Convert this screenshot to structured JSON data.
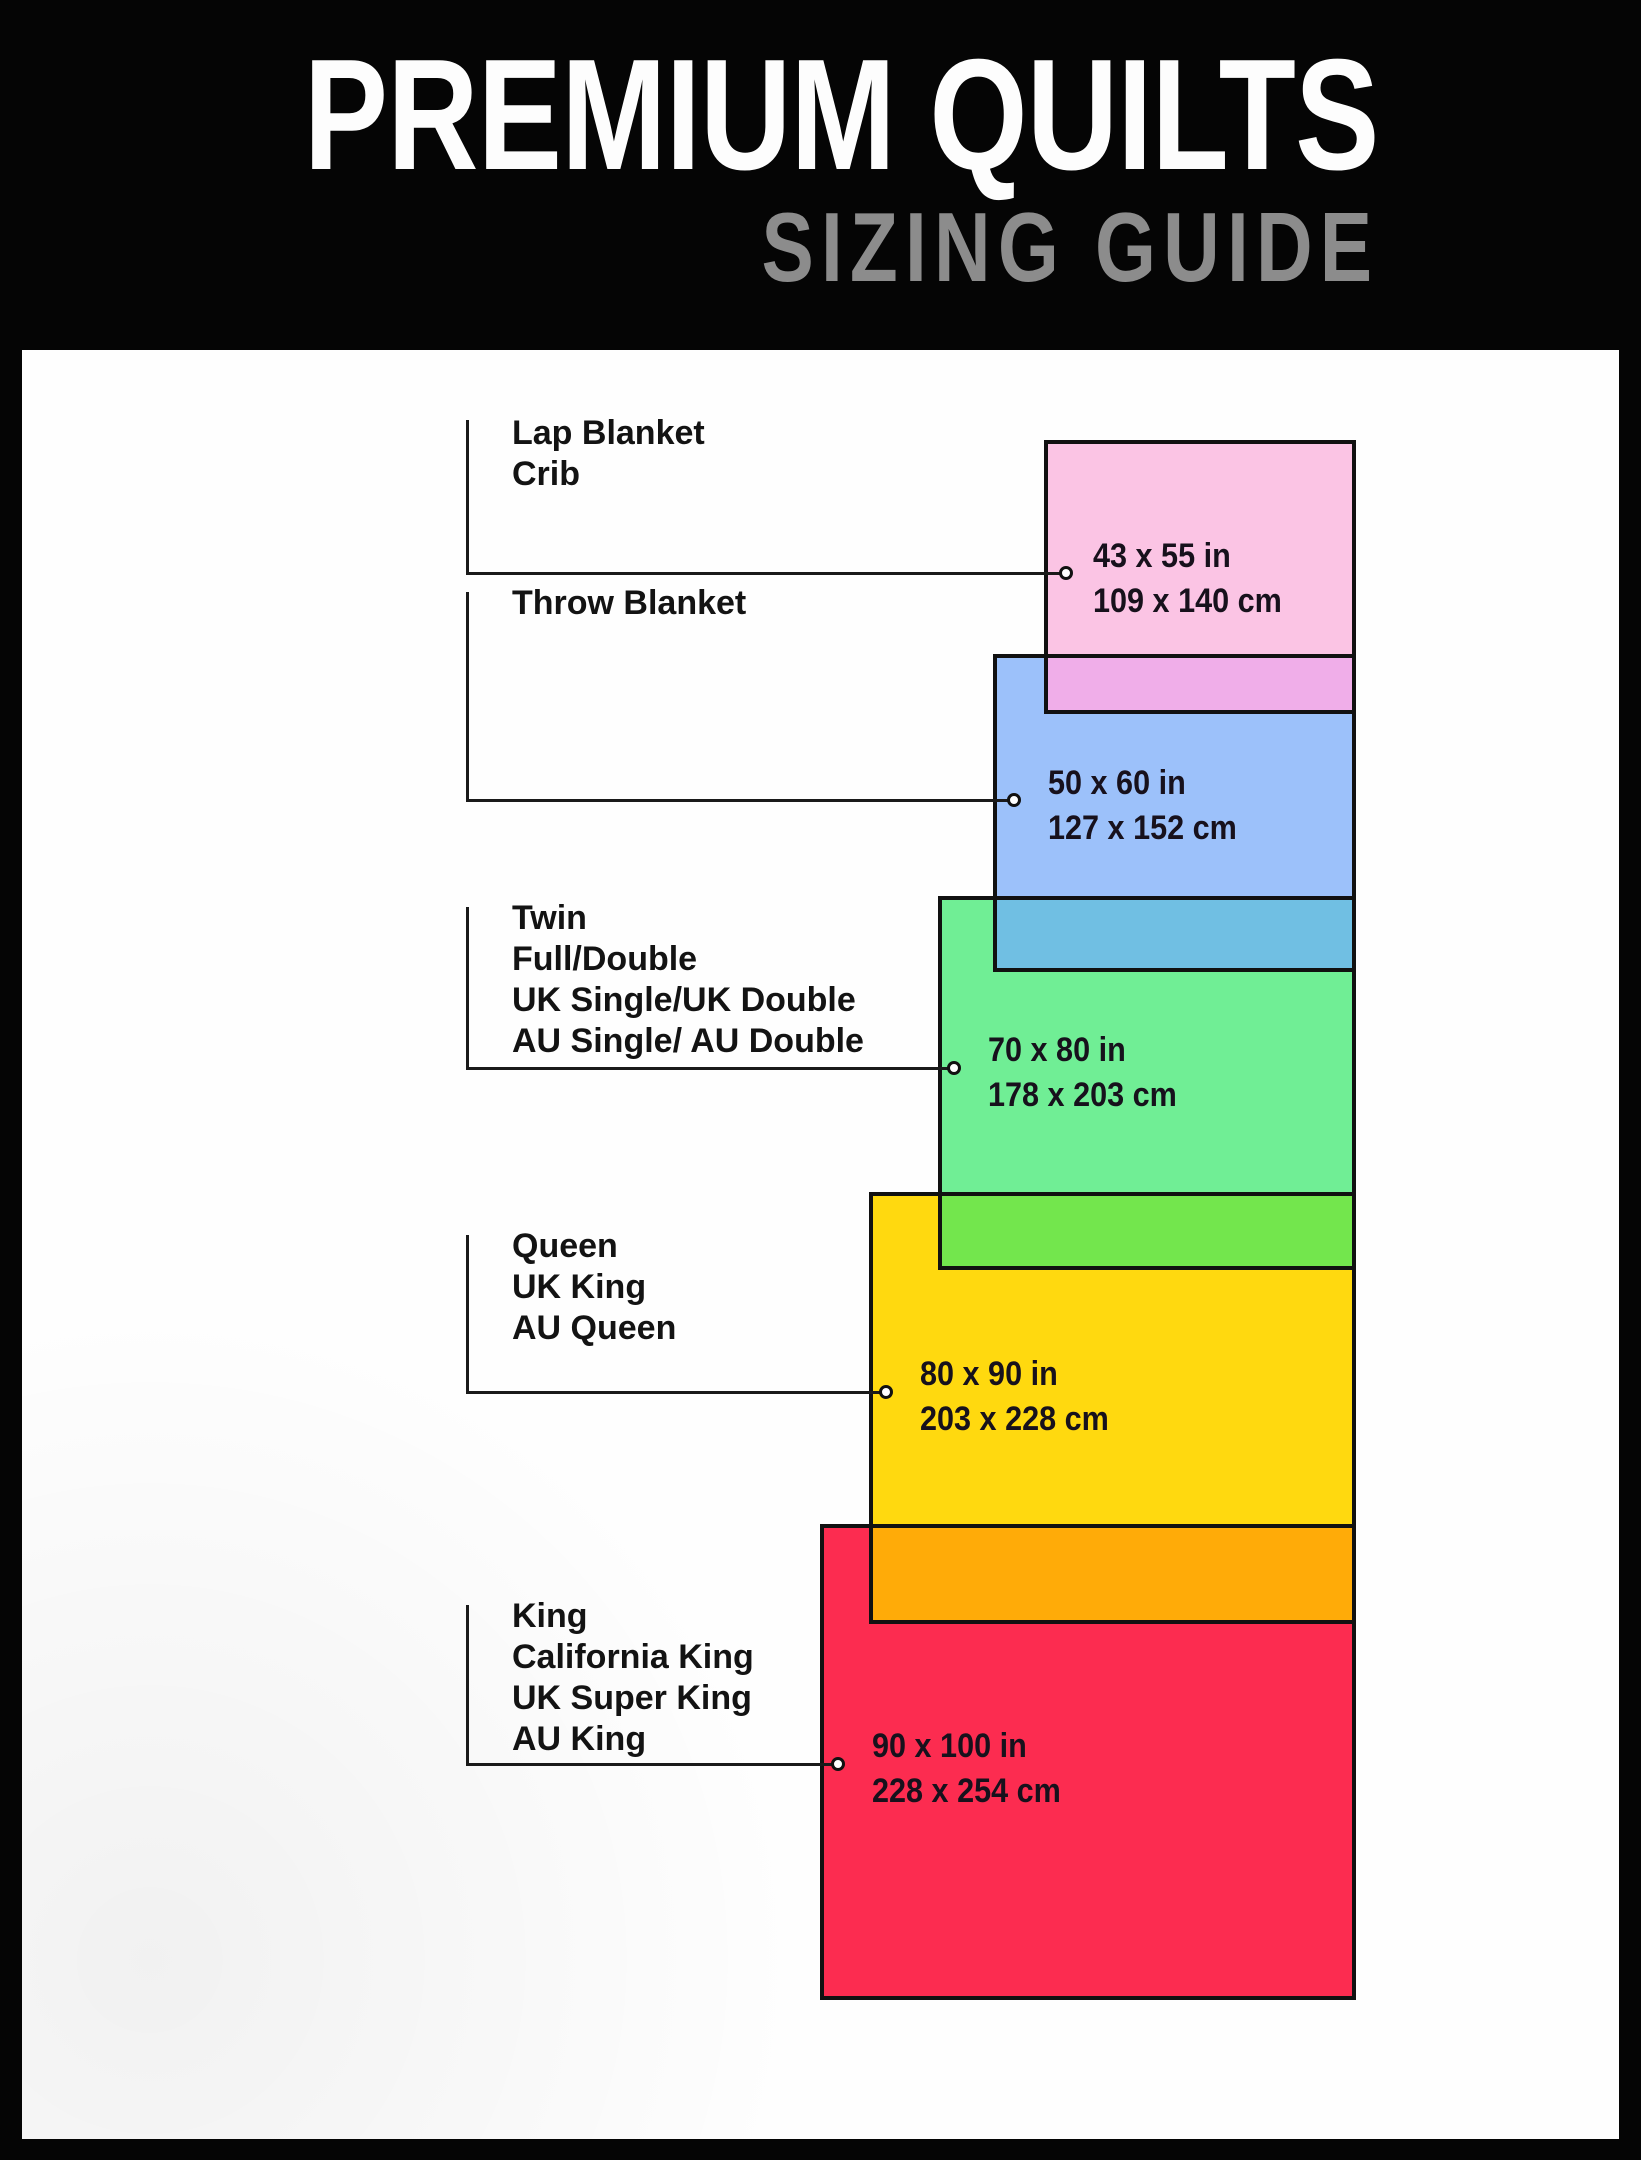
{
  "header": {
    "title": "PREMIUM QUILTS",
    "subtitle": "SIZING GUIDE",
    "colors": {
      "background": "#000000",
      "title": "#fdfdfd",
      "subtitle": "#8c8c8c"
    }
  },
  "diagram": {
    "panel_background": "#fefefe",
    "line_color": "#111111",
    "sizes": [
      {
        "id": "lap-blanket-crib",
        "labels": [
          "Lap Blanket",
          "Crib"
        ],
        "size_in": "43 x 55 in",
        "size_cm": "109 x 140 cm",
        "fill": "#fbc4e4"
      },
      {
        "id": "throw-blanket",
        "labels": [
          "Throw Blanket"
        ],
        "size_in": "50 x 60 in",
        "size_cm": "127 x 152 cm",
        "fill": "#9cc1fa"
      },
      {
        "id": "twin-full-double",
        "labels": [
          "Twin",
          "Full/Double",
          "UK Single/UK Double",
          "AU Single/ AU Double"
        ],
        "size_in": "70 x 80 in",
        "size_cm": "178 x 203 cm",
        "fill": "#70ee95"
      },
      {
        "id": "queen-uk-king-au-queen",
        "labels": [
          "Queen",
          "UK King",
          "AU Queen"
        ],
        "size_in": "80 x 90 in",
        "size_cm": "203 x 228 cm",
        "fill": "#ffd90f"
      },
      {
        "id": "king-california-king",
        "labels": [
          "King",
          "California King",
          "UK Super King",
          "AU King"
        ],
        "size_in": "90 x 100 in",
        "size_cm": "228 x 254 cm",
        "fill": "#fc2c50"
      }
    ],
    "overlap_colors": [
      "#f0aee9",
      "#70bfe3",
      "#73e64d",
      "#ffab08"
    ]
  }
}
